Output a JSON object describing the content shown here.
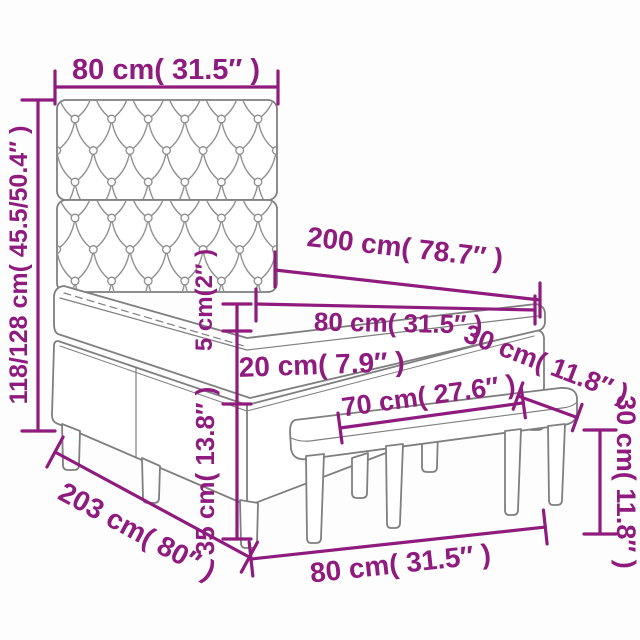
{
  "diagram": {
    "type": "furniture-dimension-diagram",
    "subject": "box spring bed with tufted headboard, mattress and bench",
    "accent_color": "#8E1B7D",
    "outline_color": "#7F7F7F",
    "dimensions": {
      "headboard_width": "80 cm( 31.5″ )",
      "headboard_height": "118/128 cm( 45.5/50.4″ )",
      "bed_length": "200 cm( 78.7″ )",
      "mattress_width": "80 cm( 31.5″ )",
      "mattress_height": "5 cm(2″ )",
      "base_height": "20 cm( 7.9″ )",
      "leg_height": "35 cm( 13.8″ )",
      "total_length": "203 cm( 80″ )",
      "bed_width": "80 cm( 31.5″ )",
      "bench_length": "70 cm( 27.6″ )",
      "bench_depth": "30 cm( 11.8″ )",
      "bench_height": "30 cm( 11.8″ )"
    }
  }
}
